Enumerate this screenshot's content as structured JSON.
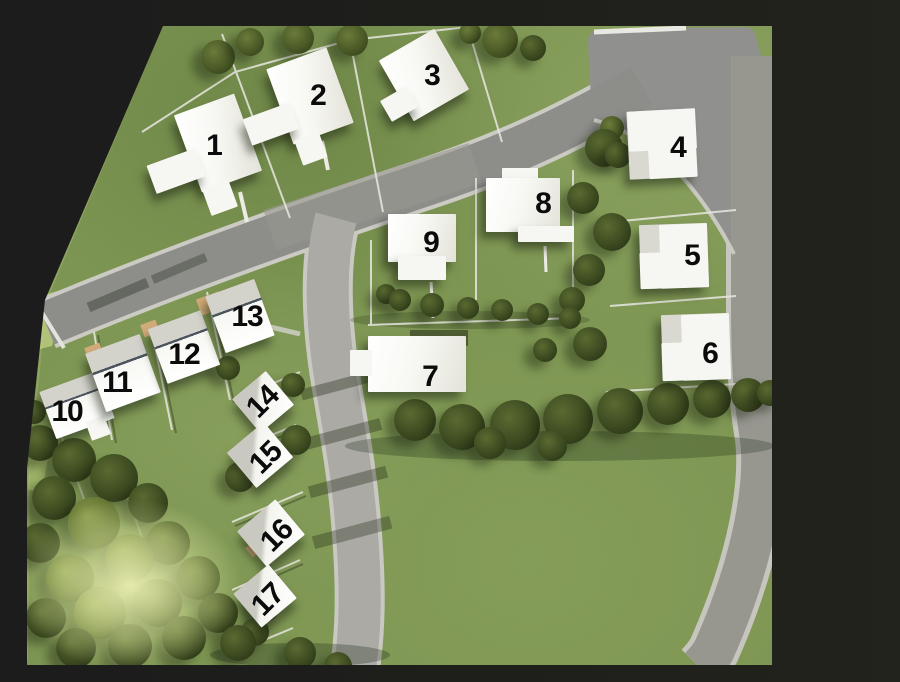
{
  "meta": {
    "description": "3D aerial rendering of a residential subdivision site plan with numbered lots",
    "style": "architectural-render"
  },
  "site": {
    "lot_count": 17,
    "lots": [
      {
        "number": "1"
      },
      {
        "number": "2"
      },
      {
        "number": "3"
      },
      {
        "number": "4"
      },
      {
        "number": "5"
      },
      {
        "number": "6"
      },
      {
        "number": "7"
      },
      {
        "number": "8"
      },
      {
        "number": "9"
      },
      {
        "number": "10"
      },
      {
        "number": "11"
      },
      {
        "number": "12"
      },
      {
        "number": "13"
      },
      {
        "number": "14"
      },
      {
        "number": "15"
      },
      {
        "number": "16"
      },
      {
        "number": "17"
      }
    ]
  },
  "colors": {
    "background": "#1e1e1b",
    "grass": "#7d9552",
    "road": "#8d8d8a",
    "curb": "#cbcbc4",
    "house": "#f6f6f2",
    "tree": "#46541f",
    "driveway": "#d2ab7a",
    "lot_line": "#e8e8e1"
  }
}
